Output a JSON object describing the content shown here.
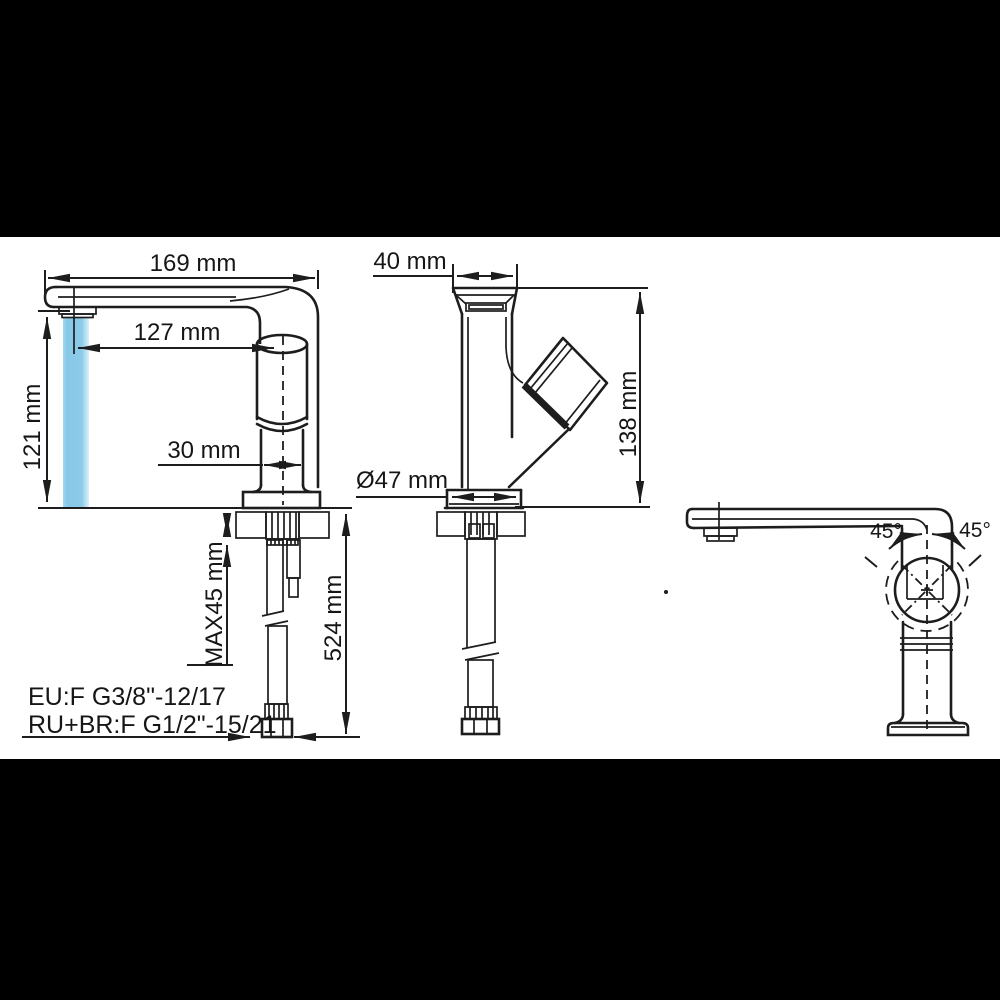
{
  "drawing": {
    "title": "basin faucet installation dimensions",
    "front_view": {
      "overall_length": "169 mm",
      "spout_reach": "127 mm",
      "spout_height": "121 mm",
      "body_width": "30 mm",
      "max_mounting_thickness": "MAX45 mm",
      "hose_length": "524 mm"
    },
    "side_view": {
      "spout_width": "40 mm",
      "total_height": "138 mm",
      "base_diameter": "Ø47 mm"
    },
    "swivel_view": {
      "rotation_left": "45°",
      "rotation_right": "45°"
    },
    "connection_notes": {
      "eu": "EU:F G3/8\"-12/17",
      "ru_br": "RU+BR:F G1/2\"-15/21"
    },
    "colors": {
      "line": "#1d1d1d",
      "water": "#8ccbe8",
      "paper": "#ffffff",
      "letterbox": "#000000"
    }
  }
}
